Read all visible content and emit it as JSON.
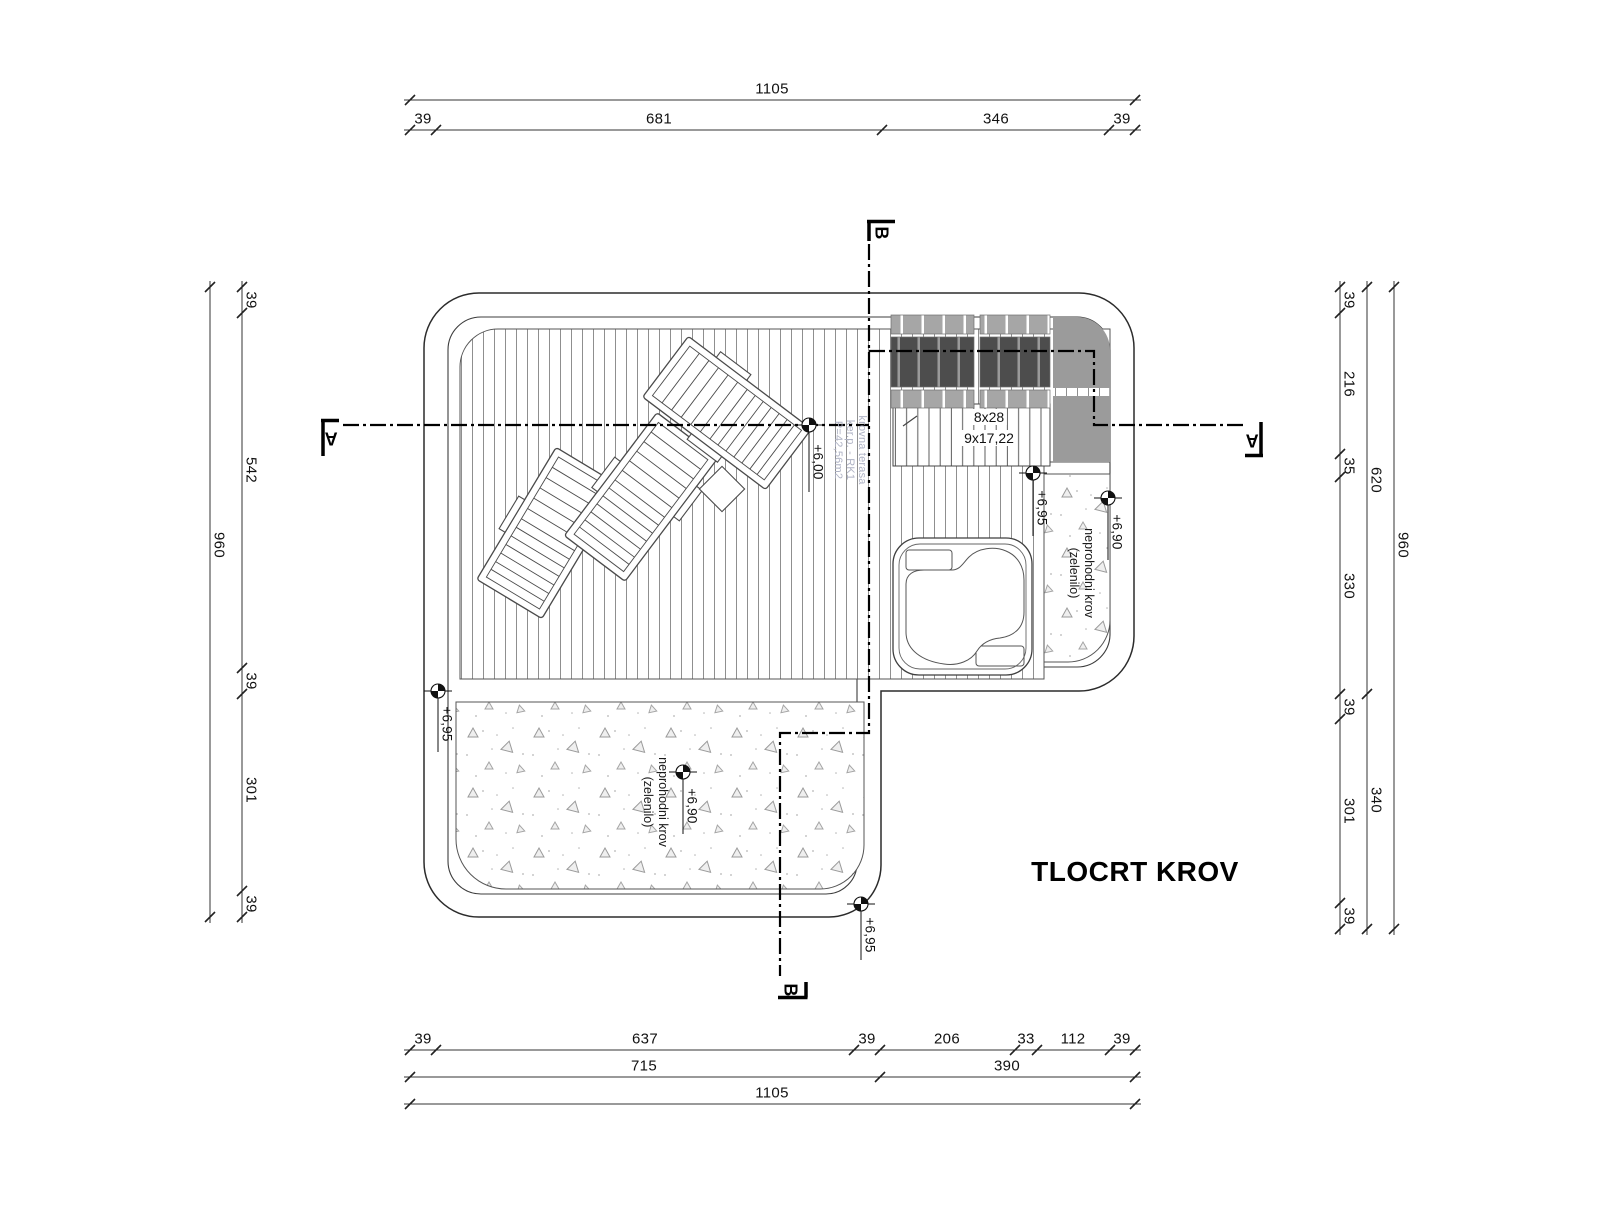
{
  "drawing": {
    "title": "TLOCRT KROV",
    "sections": {
      "a": "A",
      "b": "B"
    },
    "stairs": {
      "riser_label": "8x28",
      "tread_label": "9x17,22"
    },
    "terrace": {
      "line1": "krovna terasa",
      "line2": "ker.p. - RK1",
      "line3": "P=42,56m2"
    },
    "green_roof_right": {
      "line1": "neprohodni krov",
      "line2": "(zelenilo)",
      "elevation": "+6,90"
    },
    "green_roof_bottom": {
      "line1": "neprohodni krov",
      "line2": "(zelenilo)",
      "elevation": "+6,90"
    },
    "elevations": {
      "deck": "+6,00",
      "stair_base": "+6,95",
      "left_edge": "+6,95",
      "bottom_corner": "+6,95"
    },
    "dims": {
      "top": {
        "total": "1105",
        "chain": [
          "39",
          "681",
          "346",
          "39"
        ]
      },
      "bottom": {
        "total": "1105",
        "mid": [
          "715",
          "390"
        ],
        "chain": [
          "39",
          "637",
          "39",
          "206",
          "33",
          "112",
          "39"
        ]
      },
      "left": {
        "total": "960",
        "chain": [
          "39",
          "542",
          "39",
          "301",
          "39"
        ]
      },
      "right": {
        "total": "960",
        "mid": [
          "620",
          "340"
        ],
        "chain": [
          "39",
          "216",
          "35",
          "330",
          "39",
          "301",
          "39"
        ]
      }
    }
  }
}
